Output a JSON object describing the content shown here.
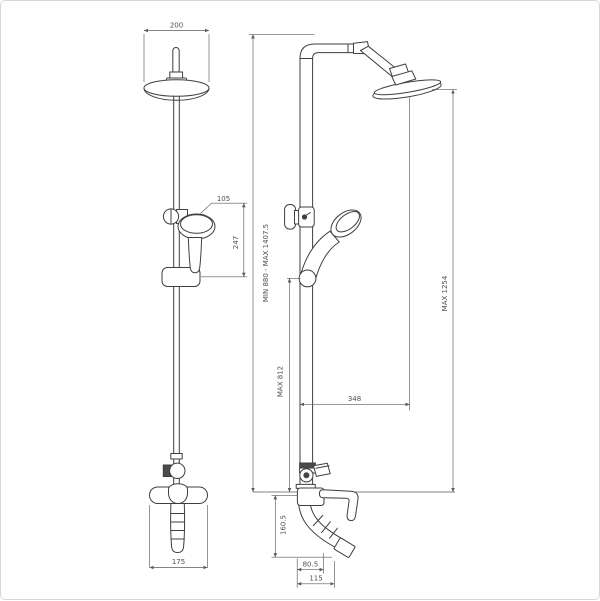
{
  "drawing_type": "shower-column-technical-drawing",
  "colors": {
    "background": "#ffffff",
    "outline": "#3f3f3f",
    "dimension_line": "#5a5a5a",
    "dimension_text": "#4f4f4f",
    "frame_border": "#d8d8d8"
  },
  "dims": {
    "head_width": "200",
    "hand_shower_width": "105",
    "hand_shower_height": "247",
    "mixer_width": "175",
    "column_height_range": "MIN 880 - MAX 1407.5",
    "hand_shower_max_height": "MAX 812",
    "overhead_max_height": "MAX 1254",
    "overhead_reach": "348",
    "spout_drop_height": "160.5",
    "spout_reach": "80.5",
    "spout_outlet_reach": "115"
  }
}
